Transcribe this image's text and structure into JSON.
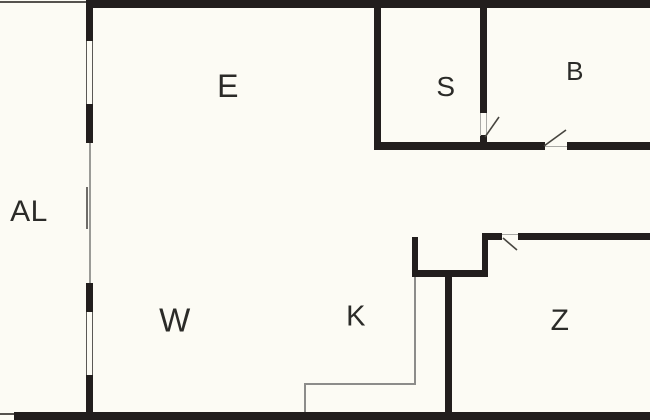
{
  "plan_type": "floor-plan",
  "rooms": [
    {
      "id": "al",
      "label": "AL"
    },
    {
      "id": "e",
      "label": "E"
    },
    {
      "id": "s",
      "label": "S"
    },
    {
      "id": "b",
      "label": "B"
    },
    {
      "id": "w",
      "label": "W"
    },
    {
      "id": "k",
      "label": "K"
    },
    {
      "id": "z",
      "label": "Z"
    }
  ],
  "colors": {
    "background": "#fcfbf4",
    "wall": "#221e1d",
    "line": "#8c8c8a",
    "door": "#47453f",
    "text": "#2b2b28"
  }
}
